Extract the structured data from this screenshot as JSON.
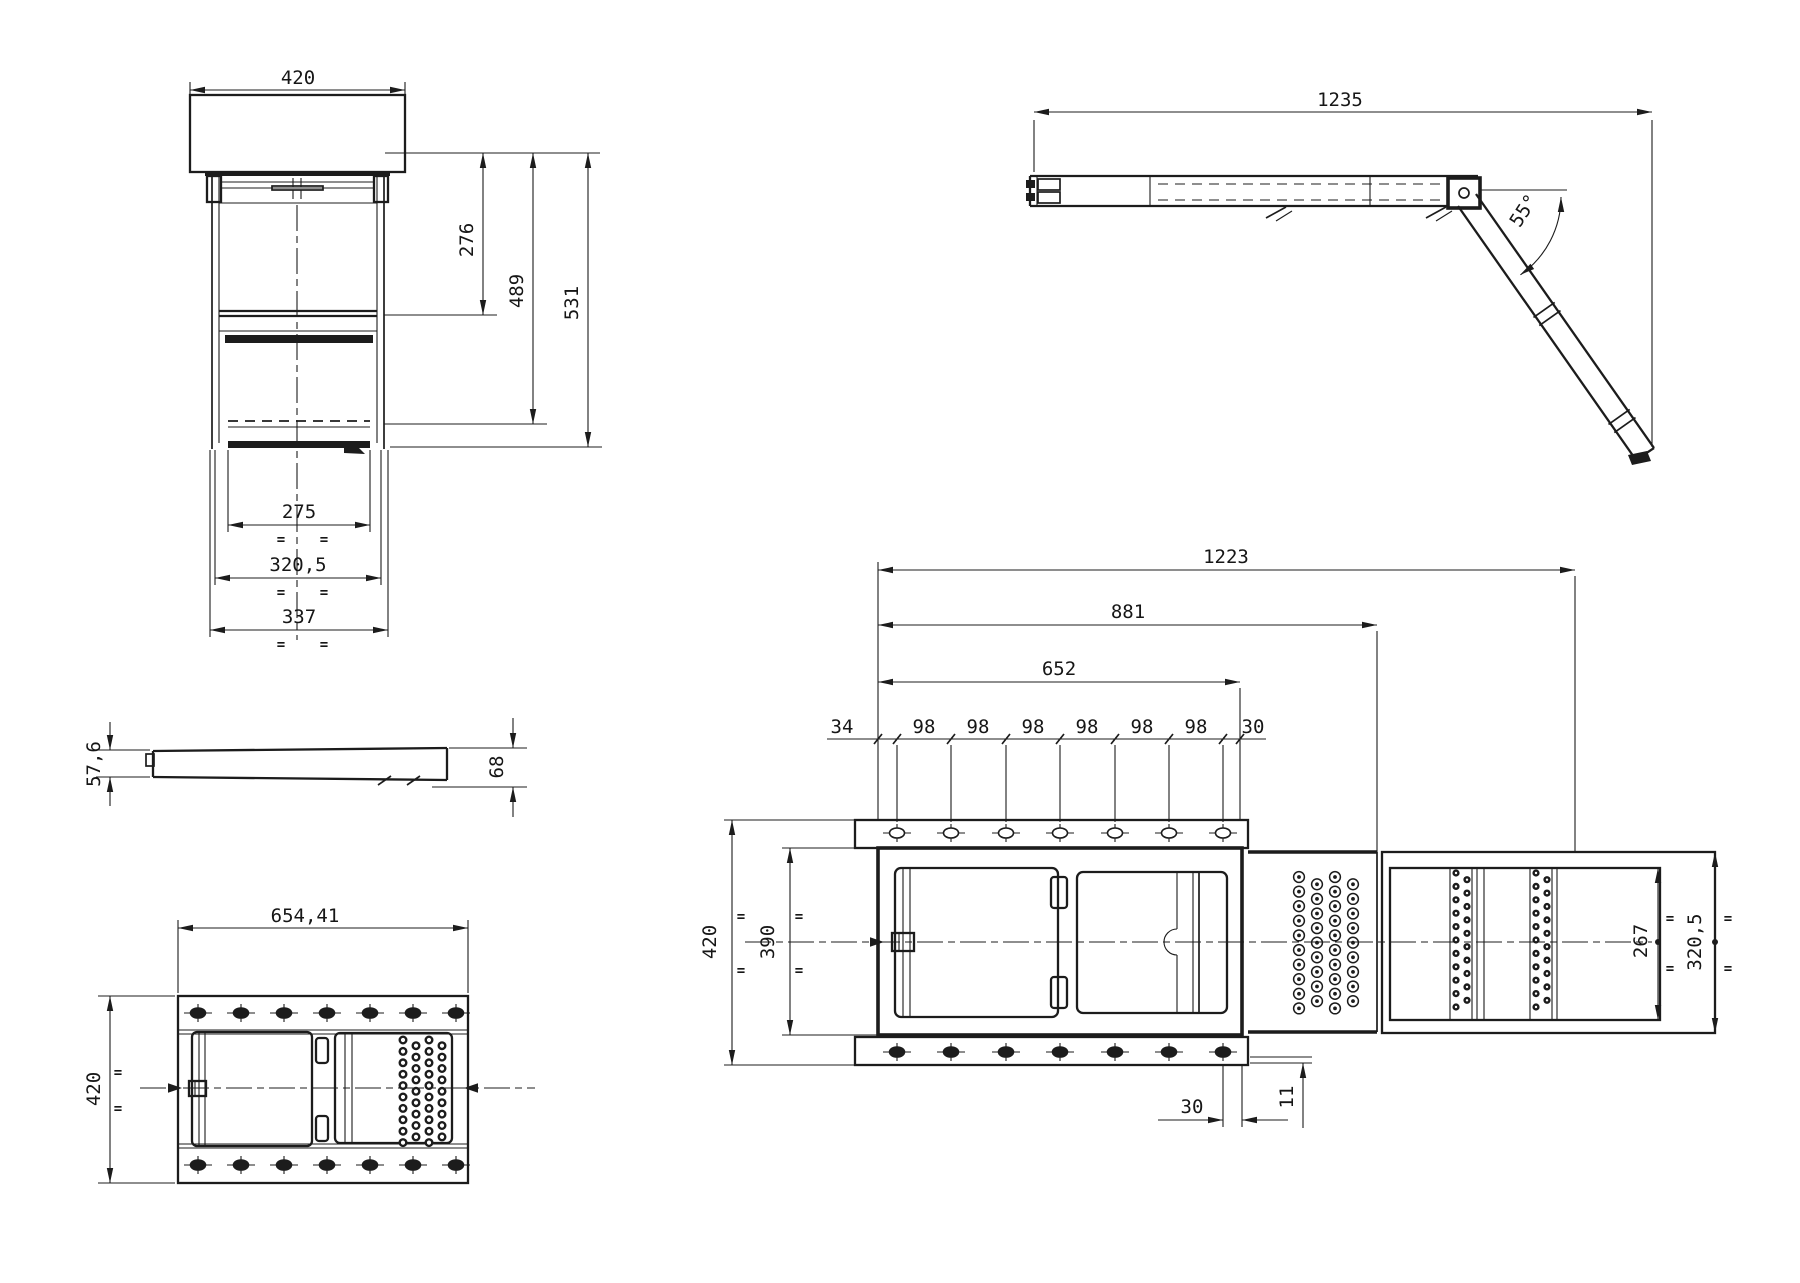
{
  "drawing": {
    "eq_mark": "=",
    "front_view": {
      "top_width": "420",
      "upper_step_height": "276",
      "lower_step_height": "489",
      "total_height": "531",
      "tread_width": "275",
      "case_width": "320,5",
      "outer_width": "337"
    },
    "side_view": {
      "extended_length": "1235",
      "leg_angle": "55°"
    },
    "profile_view": {
      "front_height": "57,6",
      "rear_height": "68"
    },
    "closed_top_view": {
      "overall_width": "654,41",
      "overall_depth": "420"
    },
    "extended_top_view": {
      "overall_length": "1223",
      "middle_step_length": "881",
      "case_length": "652",
      "lead_in": "34",
      "hole_pitch": [
        "98",
        "98",
        "98",
        "98",
        "98",
        "98"
      ],
      "end_gap": "30",
      "outer_depth": "420",
      "inner_depth": "390",
      "tread_depth": "267",
      "outer_step_depth": "320,5",
      "edge_offset": "30",
      "flange_lip": "11"
    }
  },
  "colors": {
    "ink": "#1c1c1c",
    "paper": "#ffffff"
  }
}
